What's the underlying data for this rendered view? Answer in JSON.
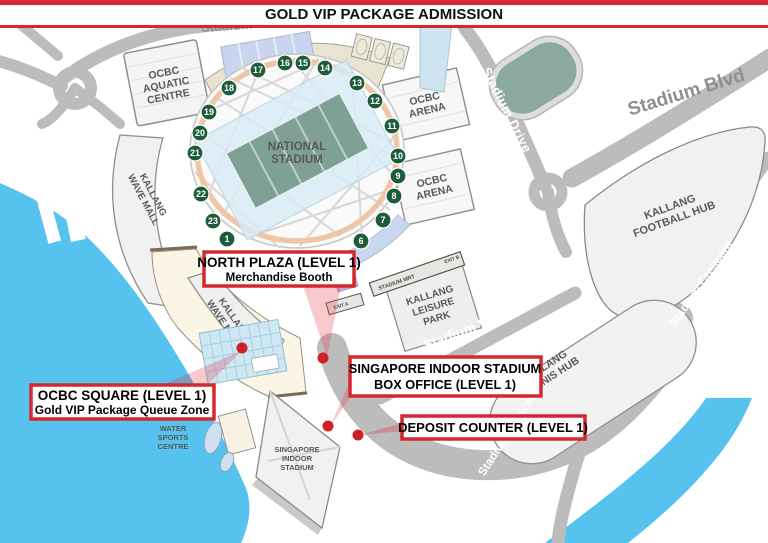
{
  "banner": {
    "title": "GOLD VIP PACKAGE ADMISSION"
  },
  "colors": {
    "accent_red": "#D5282E",
    "dot_red": "#CE2127",
    "water_blue": "#56C2EE",
    "road_gray": "#BCBCBC",
    "gate_green": "#1D5C3B",
    "field_green": "#7FA094",
    "ring_peach": "#EFC6A4",
    "label_gray": "#58595B"
  },
  "stadium": {
    "name_lines": [
      "NATIONAL",
      "STADIUM"
    ]
  },
  "gates": {
    "numbers": [
      {
        "n": "1",
        "x": 227,
        "y": 239
      },
      {
        "n": "6",
        "x": 361,
        "y": 241
      },
      {
        "n": "7",
        "x": 383,
        "y": 220
      },
      {
        "n": "8",
        "x": 394,
        "y": 196
      },
      {
        "n": "9",
        "x": 398,
        "y": 176
      },
      {
        "n": "10",
        "x": 398,
        "y": 156
      },
      {
        "n": "11",
        "x": 392,
        "y": 126
      },
      {
        "n": "12",
        "x": 375,
        "y": 101
      },
      {
        "n": "13",
        "x": 357,
        "y": 83
      },
      {
        "n": "14",
        "x": 325,
        "y": 68
      },
      {
        "n": "15",
        "x": 303,
        "y": 63
      },
      {
        "n": "16",
        "x": 285,
        "y": 63
      },
      {
        "n": "17",
        "x": 258,
        "y": 70
      },
      {
        "n": "18",
        "x": 229,
        "y": 88
      },
      {
        "n": "19",
        "x": 209,
        "y": 112
      },
      {
        "n": "20",
        "x": 200,
        "y": 133
      },
      {
        "n": "21",
        "x": 195,
        "y": 153
      },
      {
        "n": "22",
        "x": 201,
        "y": 194
      },
      {
        "n": "23",
        "x": 213,
        "y": 221
      }
    ]
  },
  "buildings": {
    "aquatic": {
      "lines": [
        "OCBC",
        "AQUATIC",
        "CENTRE"
      ]
    },
    "arena_north": {
      "lines": [
        "OCBC",
        "ARENA"
      ]
    },
    "arena_south": {
      "lines": [
        "OCBC",
        "ARENA"
      ]
    },
    "wave_mall_west": {
      "lines": [
        "KALLANG",
        "WAVE MALL"
      ]
    },
    "wave_mall_south": {
      "lines": [
        "KALLANG",
        "WAVE MALL"
      ]
    },
    "leisure_park": {
      "lines": [
        "KALLANG",
        "LEISURE",
        "PARK"
      ]
    },
    "football_hub": {
      "lines": [
        "KALLANG",
        "FOOTBALL HUB"
      ]
    },
    "tennis_hub": {
      "lines": [
        "KALLANG",
        "TENNIS HUB"
      ]
    },
    "water_sports": {
      "lines": [
        "WATER",
        "SPORTS",
        "CENTRE"
      ]
    },
    "indoor_stadium": {
      "lines": [
        "SINGAPORE",
        "INDOOR",
        "STADIUM"
      ]
    }
  },
  "transit": {
    "mrt_label": "STADIUM MRT",
    "exit_a": "EXIT A",
    "exit_b": "EXIT B"
  },
  "roads": {
    "drive_top": "Stadium Drive",
    "drive_east": "Stadium Drive",
    "blvd": "Stadium Blvd",
    "walk": "Stadium Walk",
    "crescent_east": "Stadium Crescent",
    "crescent_south": "Stadium Crescent"
  },
  "callouts": {
    "north_plaza": {
      "title": "NORTH PLAZA (LEVEL 1)",
      "subtitle": "Merchandise Booth"
    },
    "ocbc_square": {
      "title": "OCBC SQUARE (LEVEL 1)",
      "subtitle": "Gold VIP Package Queue Zone"
    },
    "box_office": {
      "line1": "SINGAPORE INDOOR STADIUM",
      "line2": "BOX OFFICE (LEVEL 1)"
    },
    "deposit": {
      "title": "DEPOSIT COUNTER (LEVEL 1)"
    }
  }
}
